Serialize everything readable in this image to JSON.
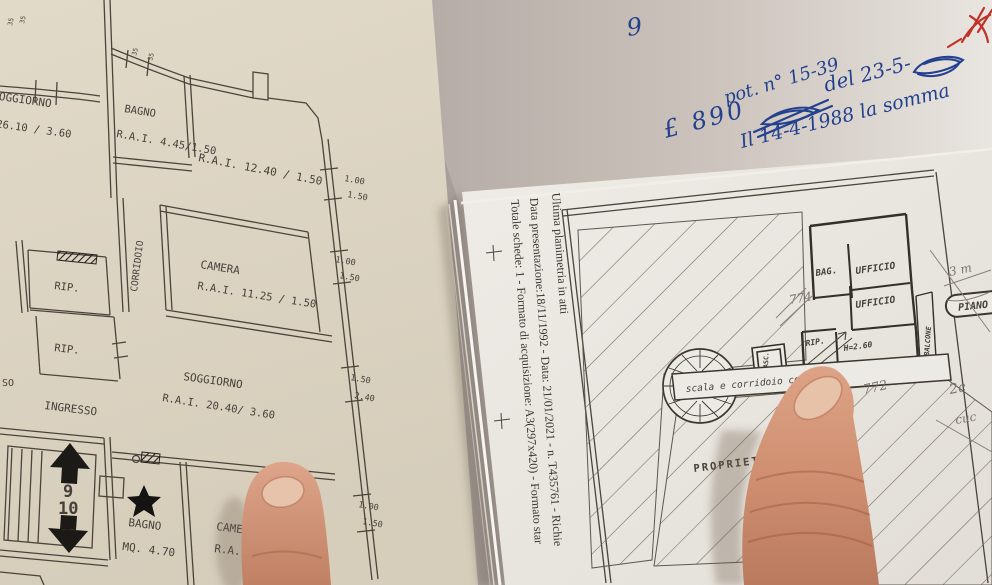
{
  "colors": {
    "table": "#a89f9b",
    "left_paper": "#ddd5c4",
    "held_paper": "#e9e6e1",
    "notes_sheet": "#cfc5bf",
    "plan_ink": "#46403a",
    "blue_ink": "#23418f",
    "red_ink": "#c13227",
    "pencil": "#7c736a",
    "skin": "#d79a7e",
    "nail": "#e8c3ab"
  },
  "left_plan": {
    "rooms": {
      "soggiorno_top": {
        "name": "SOGGIORNO",
        "rai": "R.A.I.  26.10 / 3.60"
      },
      "bagno_top": {
        "name": "BAGNO",
        "rai": "R.A.I. 4.45/1.50"
      },
      "room_1240": {
        "rai": "R.A.I.  12.40 / 1.50"
      },
      "corridoio": {
        "name": "CORRIDOIO"
      },
      "rip_1": {
        "name": "RIP."
      },
      "rip_2": {
        "name": "RIP."
      },
      "camera_mid": {
        "name": "CAMERA",
        "rai": "R.A.I.  11.25 / 1.50"
      },
      "soggiorno_main": {
        "name": "SOGGIORNO",
        "rai": "R.A.I.  20.40/ 3.60"
      },
      "ingresso": {
        "name": "INGRESSO"
      },
      "bagno_low": {
        "name": "BAGNO",
        "mq": "MQ.  4.70"
      },
      "camera_low": {
        "name": "CAMERA",
        "rai": "R.A.I.  11."
      },
      "edge_fragment": "SO"
    },
    "stair": {
      "up": "9",
      "down": "10"
    },
    "dims": [
      "1.00",
      "1.50",
      "1.00",
      "1.50",
      "1.50",
      "2.40",
      "1.00",
      "1.50"
    ],
    "tiny_dims": [
      "35",
      "35",
      "35",
      "35"
    ]
  },
  "right_sheet": {
    "captions": [
      "Ultima planimetria in atti",
      "Data presentazione:18/11/1992 - Data: 21/01/2021 - n. T435761 - Richie",
      "Totale schede: 1 - Formato di acquisizione: A3(297x420) - Formato star"
    ],
    "rooms": {
      "bag": "BAG.",
      "ufficio1": "UFFICIO",
      "ufficio2": "UFFICIO",
      "rip": "RIP.",
      "altezza": "H=2.60",
      "balcone": "BALCONE",
      "asc": "ASC."
    },
    "corridor": "scala e corridoio comu",
    "property": "PROPRIETÀ \"SIAR",
    "piano": "PIANO",
    "pencil_notes": [
      "774",
      "772",
      "3 m",
      "2c",
      "cuc"
    ]
  },
  "handwriting": {
    "page_number": "9",
    "note_prot": "pot. n° 15-39",
    "note_lire": "£ 890",
    "note_del": "del 23-5-",
    "note_1988": "Il 14-4-1988 la somma"
  }
}
